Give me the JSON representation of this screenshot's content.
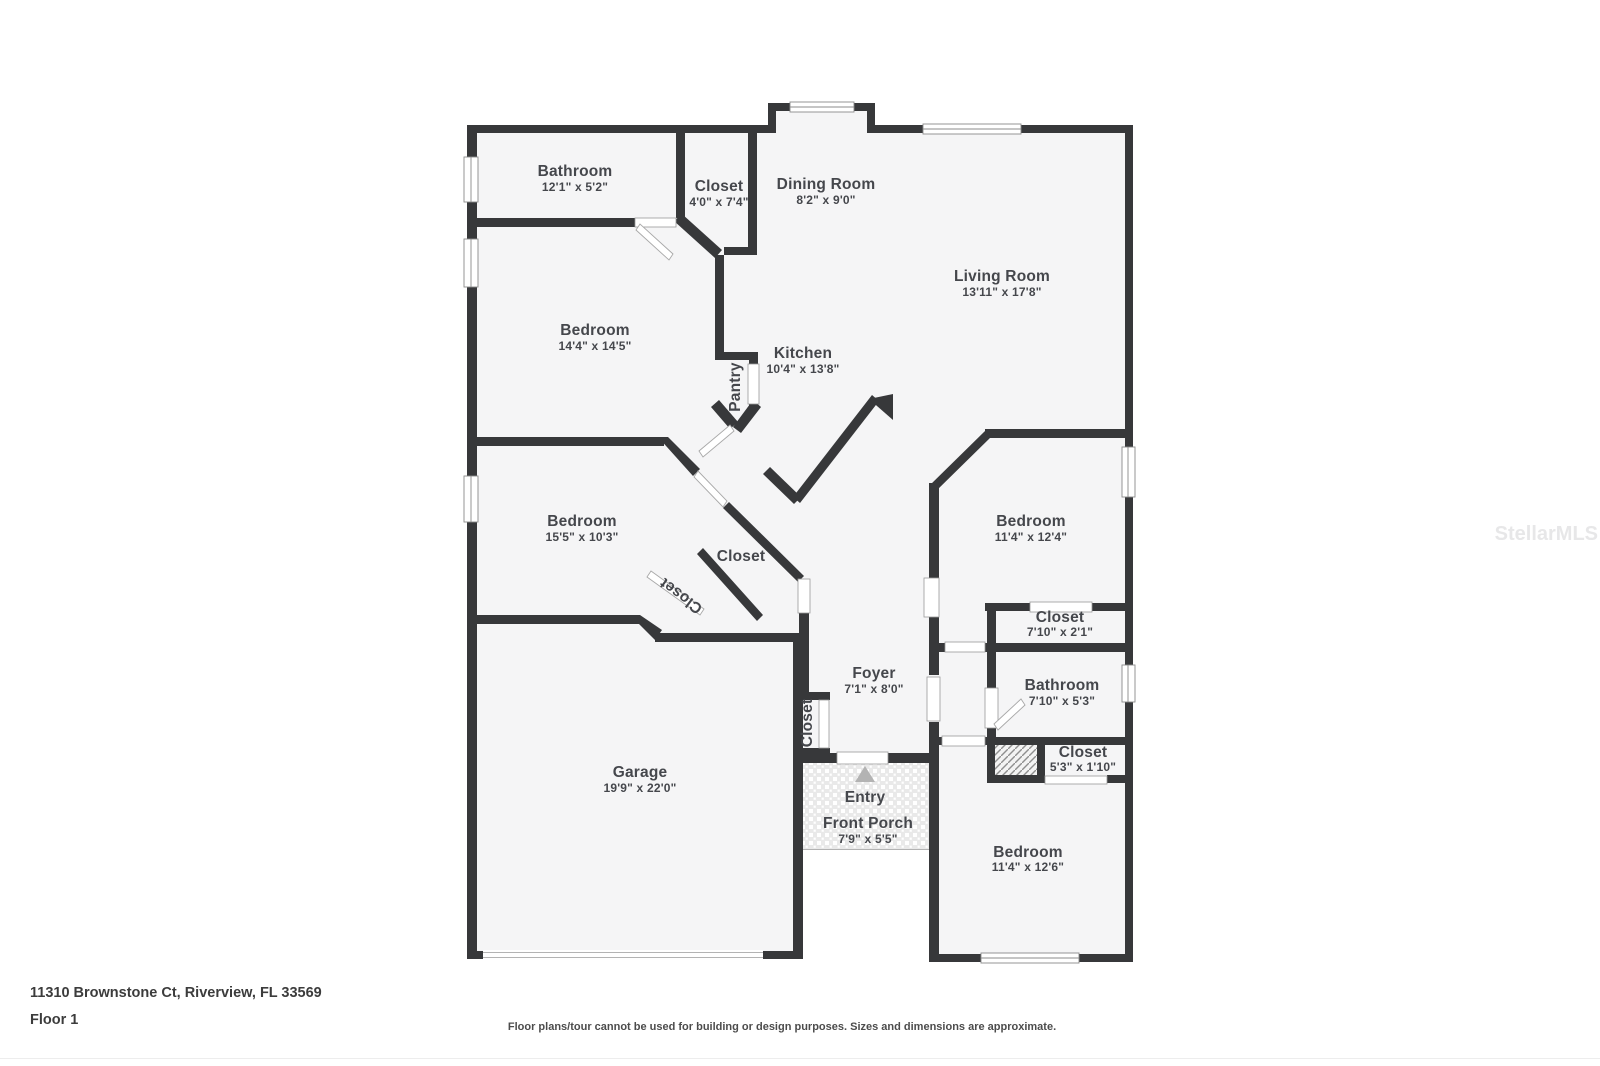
{
  "title": "Floor plan",
  "footer": {
    "address_line": "11310 Brownstone Ct, Riverview, FL 33569",
    "floor_label": "Floor 1",
    "disclaimer": "Floor plans/tour cannot be used for building or design purposes. Sizes and dimensions are approximate."
  },
  "watermark": "StellarMLS",
  "colors": {
    "wall": "#37383a",
    "floor": "#f5f5f6",
    "label_text": "#45474c",
    "porch_tile": "#eaeaea",
    "entry_arrow": "#b3b3b3"
  },
  "rooms": [
    {
      "name": "Bathroom",
      "dims": "12'1\" x 5'2\""
    },
    {
      "name": "Closet",
      "dims": "4'0\" x 7'4\""
    },
    {
      "name": "Dining Room",
      "dims": "8'2\" x 9'0\""
    },
    {
      "name": "Living Room",
      "dims": "13'11\" x 17'8\""
    },
    {
      "name": "Bedroom",
      "dims": "14'4\" x 14'5\""
    },
    {
      "name": "Kitchen",
      "dims": "10'4\" x 13'8\""
    },
    {
      "name": "Pantry",
      "dims": ""
    },
    {
      "name": "Bedroom",
      "dims": "15'5\" x 10'3\""
    },
    {
      "name": "Closet",
      "dims": ""
    },
    {
      "name": "Closet",
      "dims": ""
    },
    {
      "name": "Bedroom",
      "dims": "11'4\" x 12'4\""
    },
    {
      "name": "Closet",
      "dims": "7'10\" x 2'1\""
    },
    {
      "name": "Bathroom",
      "dims": "7'10\" x 5'3\""
    },
    {
      "name": "Closet",
      "dims": "5'3\" x 1'10\""
    },
    {
      "name": "Foyer",
      "dims": "7'1\" x 8'0\""
    },
    {
      "name": "Closet",
      "dims": ""
    },
    {
      "name": "Entry",
      "dims": ""
    },
    {
      "name": "Front Porch",
      "dims": "7'9\" x 5'5\""
    },
    {
      "name": "Garage",
      "dims": "19'9\" x 22'0\""
    },
    {
      "name": "Bedroom",
      "dims": "11'4\" x 12'6\""
    }
  ]
}
